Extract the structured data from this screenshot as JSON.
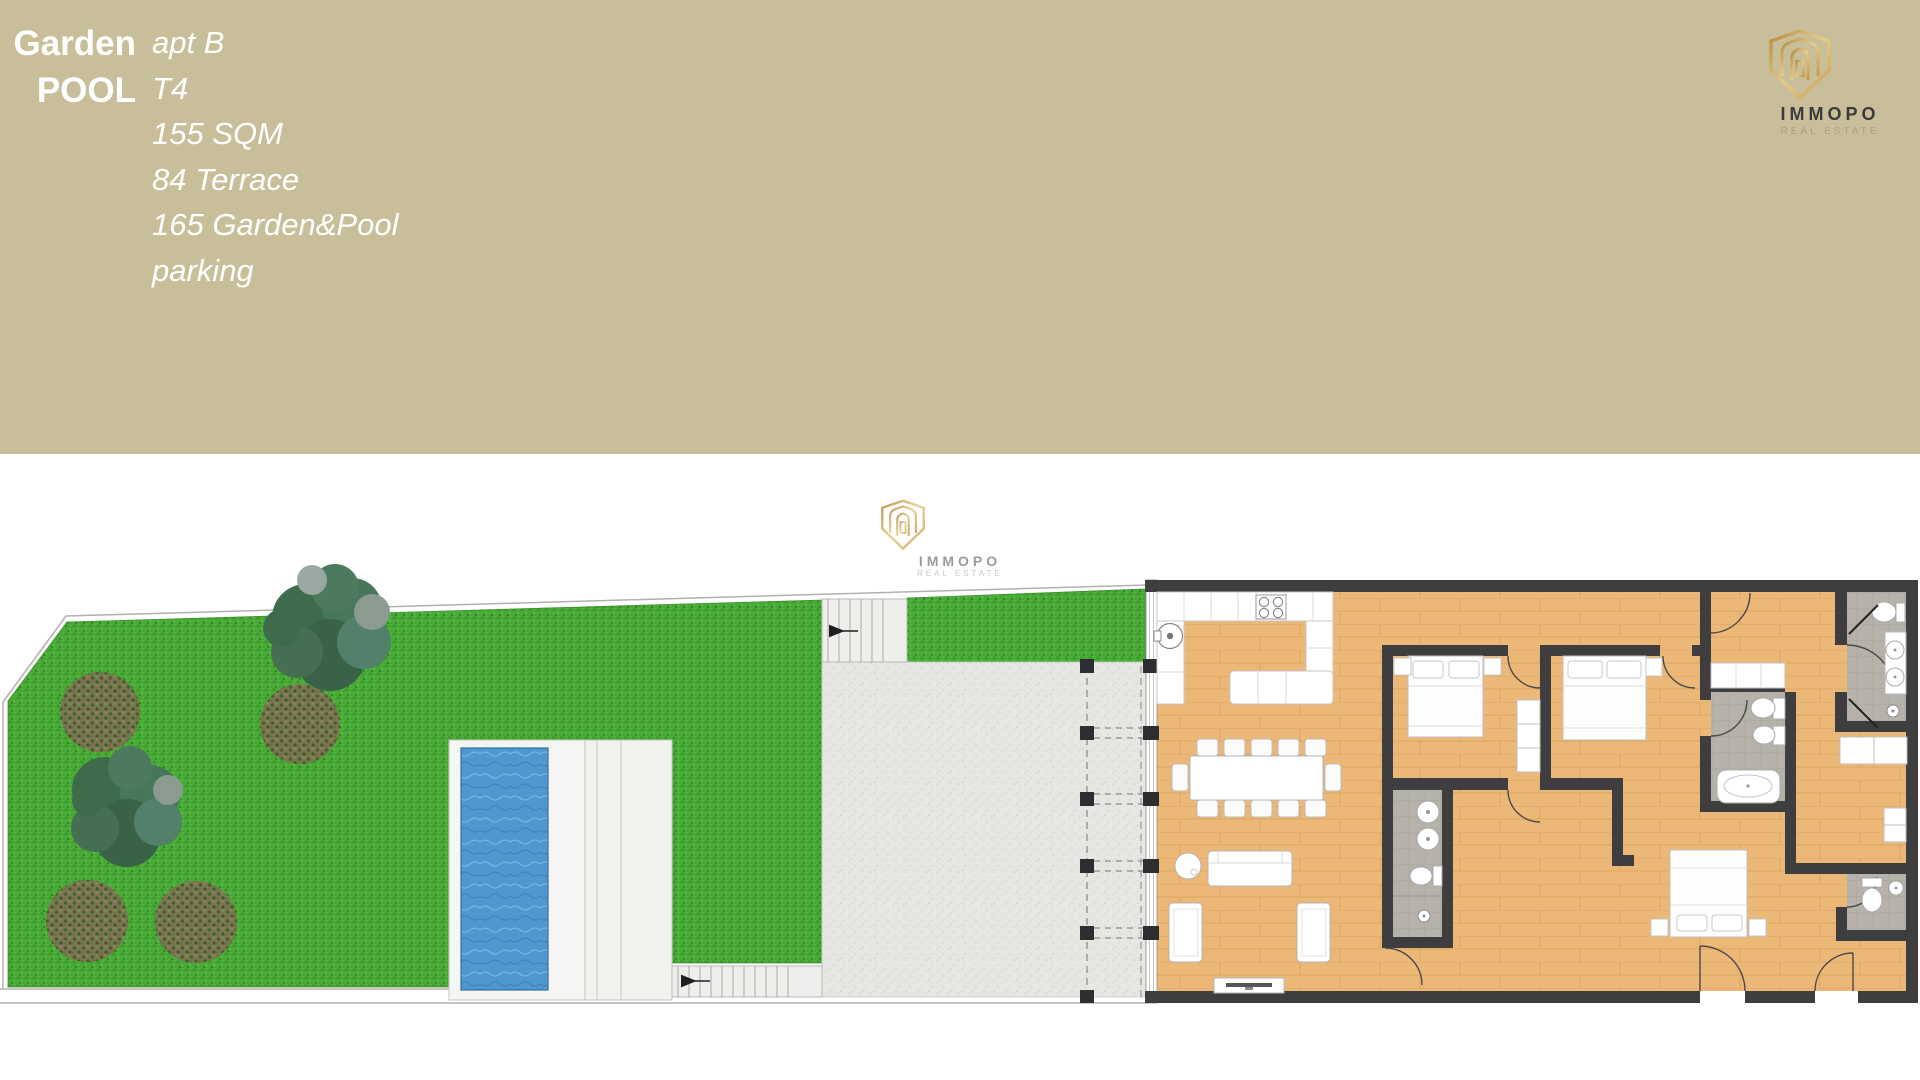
{
  "header": {
    "background": "#c8bf9a",
    "title_line1": "Garden",
    "title_line2": "POOL",
    "details": [
      "apt B",
      "T4",
      "155 SQM",
      "84 Terrace",
      "165 Garden&Pool",
      "parking"
    ]
  },
  "brand": {
    "name": "IMMOPO",
    "tagline": "REAL ESTATE"
  },
  "watermark": {
    "name": "IMMOPO",
    "tagline": "REAL ESTATE"
  },
  "plan": {
    "colors": {
      "grass": "#48a937",
      "tree": "#47775a",
      "bush": "#7c7750",
      "pool_water": "#4f98cf",
      "pool_deck": "#f5f5f3",
      "terrace": "#e6e6e3",
      "stairs": "#eeeeec",
      "wood_floor": "#ecb878",
      "walls": "#3e3e40",
      "bathroom_tile": "#b6b2a9",
      "furniture": "#ffffff",
      "boundary_line": "#b3b1ac",
      "brand_gold": "#c9a85c"
    }
  }
}
